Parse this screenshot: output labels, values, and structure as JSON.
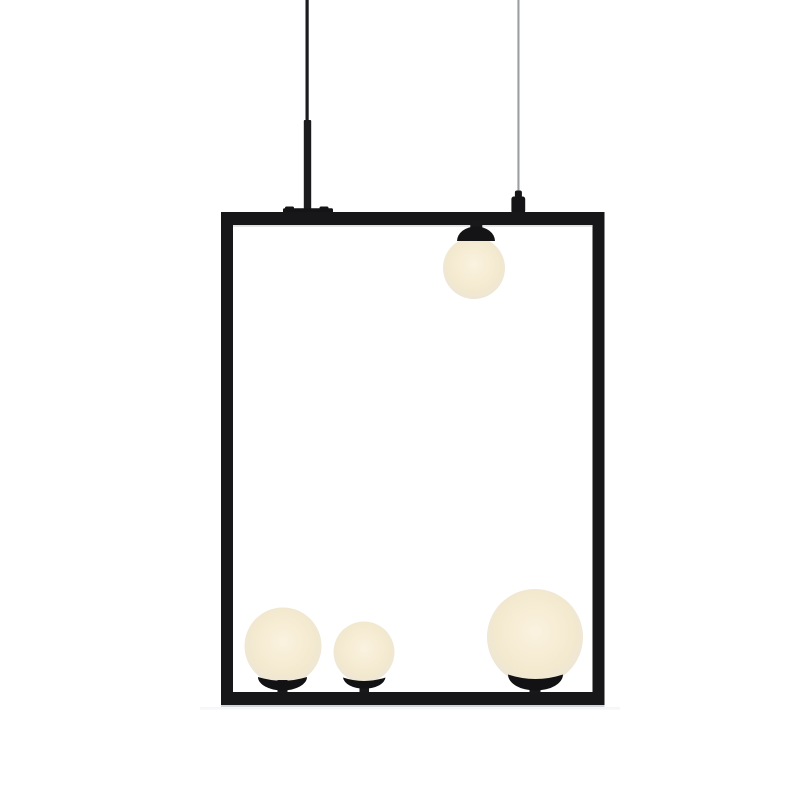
{
  "meta": {
    "description": "Product photograph of a minimalist pendant ceiling lamp: a thin black rectangular metal frame suspended from above by one black rod and one thin grey cable, holding four frosted opal glass globes glowing warm white",
    "background": "#ffffff"
  },
  "colors": {
    "frame": "#17171a",
    "rod": "#1b1b1e",
    "plate": "#141417",
    "cable": "#9aa0a1",
    "fitting": "#151518",
    "cap": "#141416",
    "cup": "#121214",
    "stem": "#18181b",
    "shadow_top": "#b4b8b4",
    "shadow_bottom": "#a9aeba",
    "shadow_soft": "#c7cbd2",
    "globe_center": "#faf2e0",
    "globe_mid": "#f7edd5",
    "globe_outer": "#f3e9cf",
    "globe_edge": "#efe7d4",
    "globe_rim": "#eae4d7"
  },
  "fixture": {
    "frame": {
      "left": 221,
      "top": 212,
      "right": 604,
      "bottom": 705,
      "bar_thickness": 12
    },
    "suspension": {
      "rod_x": 307,
      "cable_x": 518
    },
    "globes": [
      {
        "id": "top-hanging",
        "cx": 474,
        "cy": 268,
        "r": 31
      },
      {
        "id": "bottom-left",
        "cx": 283,
        "cy": 646,
        "r": 38.5
      },
      {
        "id": "bottom-middle",
        "cx": 364,
        "cy": 652,
        "r": 30.5
      },
      {
        "id": "bottom-right",
        "cx": 535,
        "cy": 637,
        "r": 48
      }
    ]
  }
}
